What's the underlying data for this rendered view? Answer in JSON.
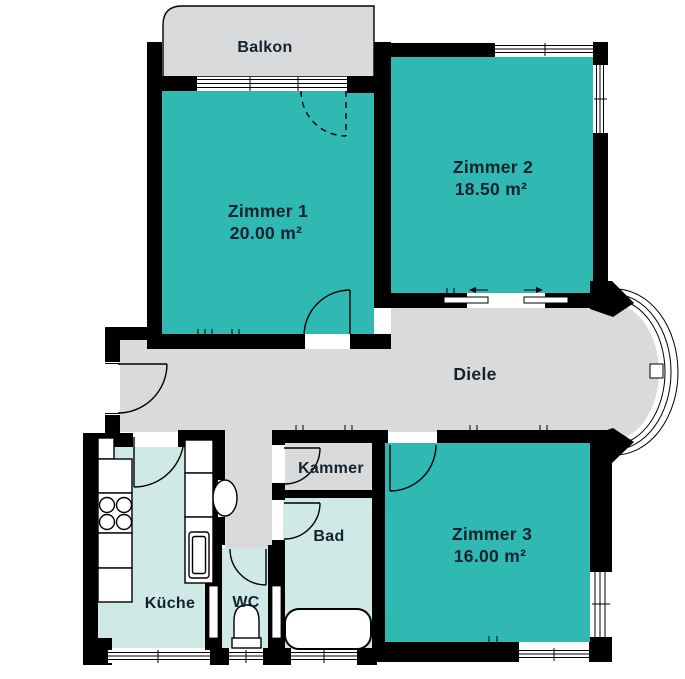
{
  "plan": {
    "balkon": {
      "label": "Balkon"
    },
    "zimmer1": {
      "label": "Zimmer 1",
      "area": "20.00 m²"
    },
    "zimmer2": {
      "label": "Zimmer 2",
      "area": "18.50 m²"
    },
    "zimmer3": {
      "label": "Zimmer 3",
      "area": "16.00 m²"
    },
    "diele": {
      "label": "Diele"
    },
    "kammer": {
      "label": "Kammer"
    },
    "bad": {
      "label": "Bad"
    },
    "kueche": {
      "label": "Küche"
    },
    "wc": {
      "label": "WC"
    }
  },
  "colors": {
    "room-teal": "#2fb9b2",
    "room-light": "#cfe9e6",
    "floor-gray": "#d8dadc",
    "wall-black": "#000000",
    "text-dark": "#13222e",
    "background": "#ffffff"
  }
}
